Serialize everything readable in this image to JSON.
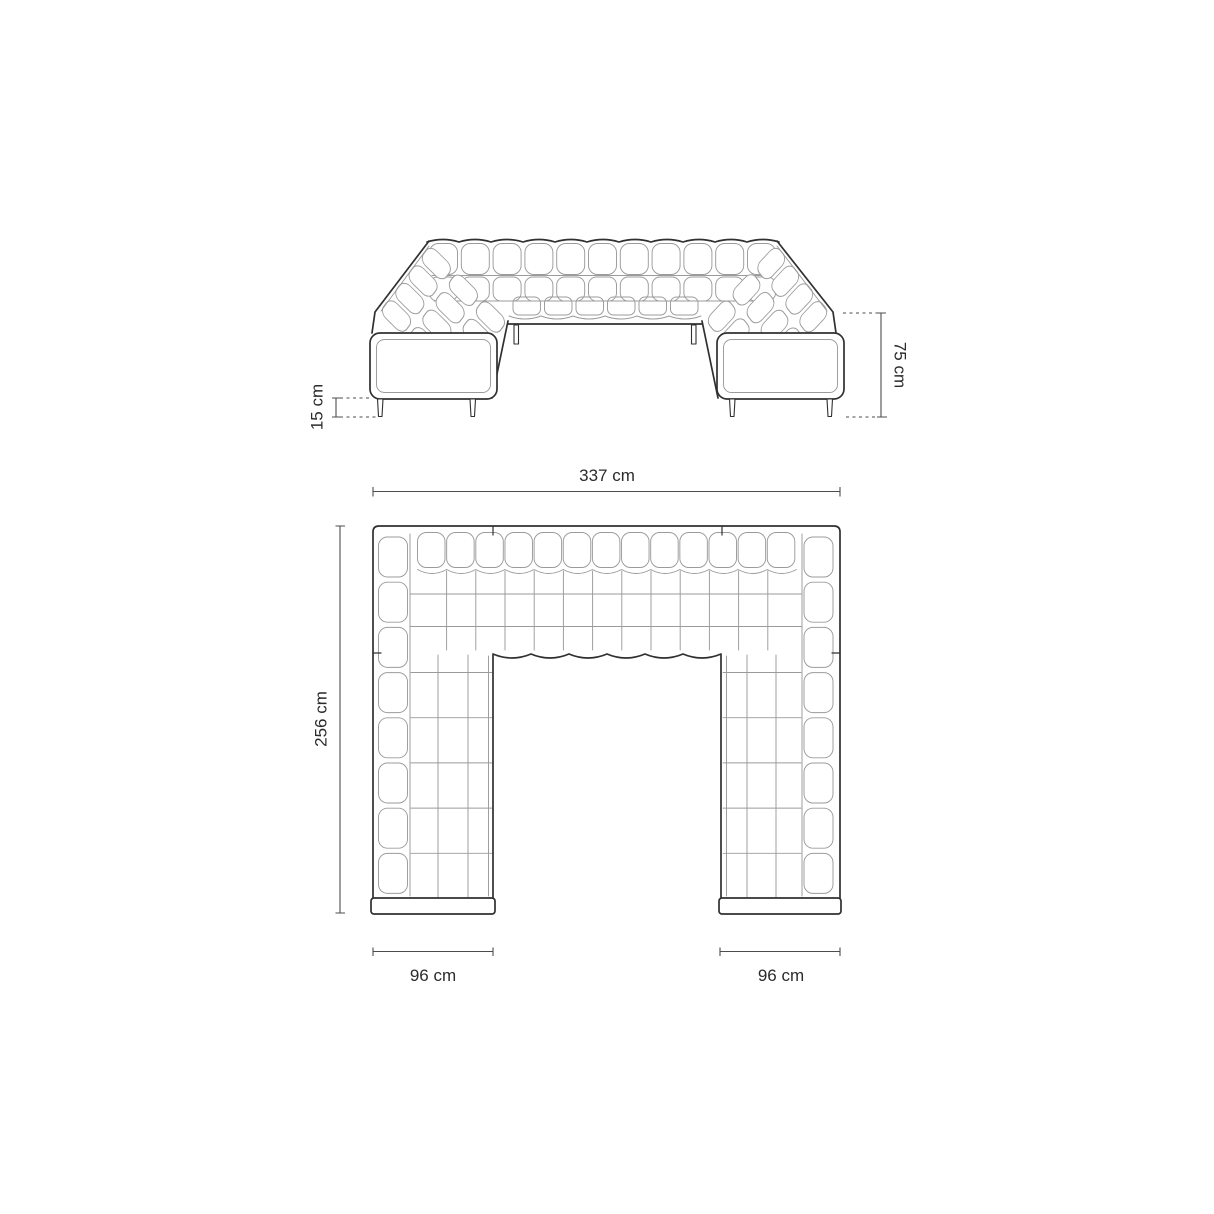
{
  "diagram": {
    "kind": "sofa-dimension-drawing",
    "colors": {
      "background": "#ffffff",
      "outline": "#303030",
      "tufting_lines": "#9b9b9b",
      "dimension_lines": "#4d4d4d",
      "dimension_text": "#2b2b2b"
    },
    "dimensions": {
      "total_height": {
        "label": "75 cm",
        "value": 75,
        "unit": "cm"
      },
      "leg_height": {
        "label": "15 cm",
        "value": 15,
        "unit": "cm"
      },
      "total_width": {
        "label": "337 cm",
        "value": 337,
        "unit": "cm"
      },
      "total_depth": {
        "label": "256 cm",
        "value": 256,
        "unit": "cm"
      },
      "left_arm_width": {
        "label": "96 cm",
        "value": 96,
        "unit": "cm"
      },
      "right_arm_width": {
        "label": "96 cm",
        "value": 96,
        "unit": "cm"
      }
    }
  }
}
